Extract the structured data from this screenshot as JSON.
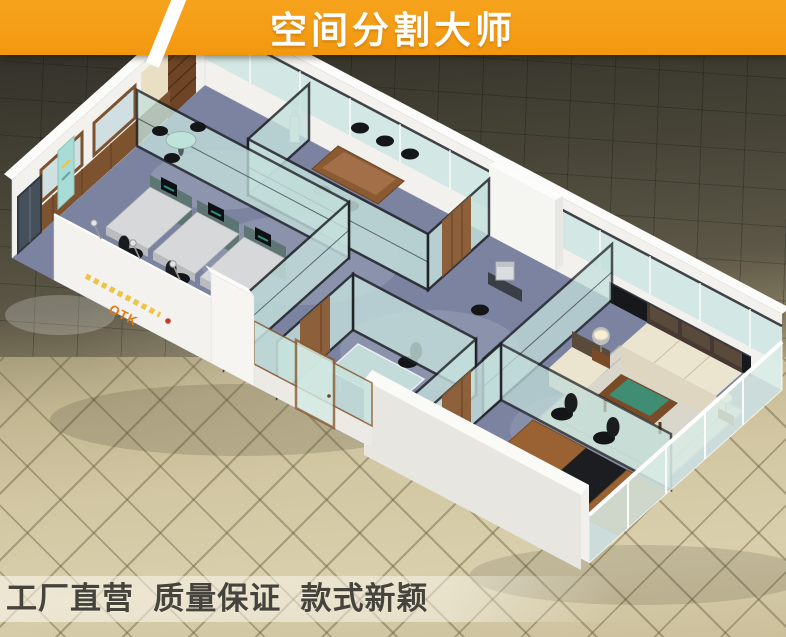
{
  "banner": {
    "title": "空间分割大师"
  },
  "slogan": {
    "text": "工厂直营  质量保证  款式新颖"
  },
  "office": {
    "logo": "OTK",
    "colors": {
      "banner_orange": "#F59D18",
      "banner_text": "#FFFFFF",
      "slogan_text": "#45433B",
      "tile_dark": "#4A463A",
      "tile_light": "#D5CAA6",
      "carpet_blue": "#7B83A1",
      "wall_white": "#F2F1ED",
      "wood_brown": "#7D532F",
      "partition_glass": "#CCE5E0",
      "partition_frame": "#1D2024",
      "sofa_cream": "#EBE4CF",
      "sofa_back_brown": "#473931",
      "coffee_table_green": "#3F8D72",
      "logo_orange": "#E07818"
    },
    "areas": [
      "reception",
      "workstations",
      "conference-room",
      "copier-room",
      "glass-office",
      "lounge",
      "executive-office"
    ]
  }
}
